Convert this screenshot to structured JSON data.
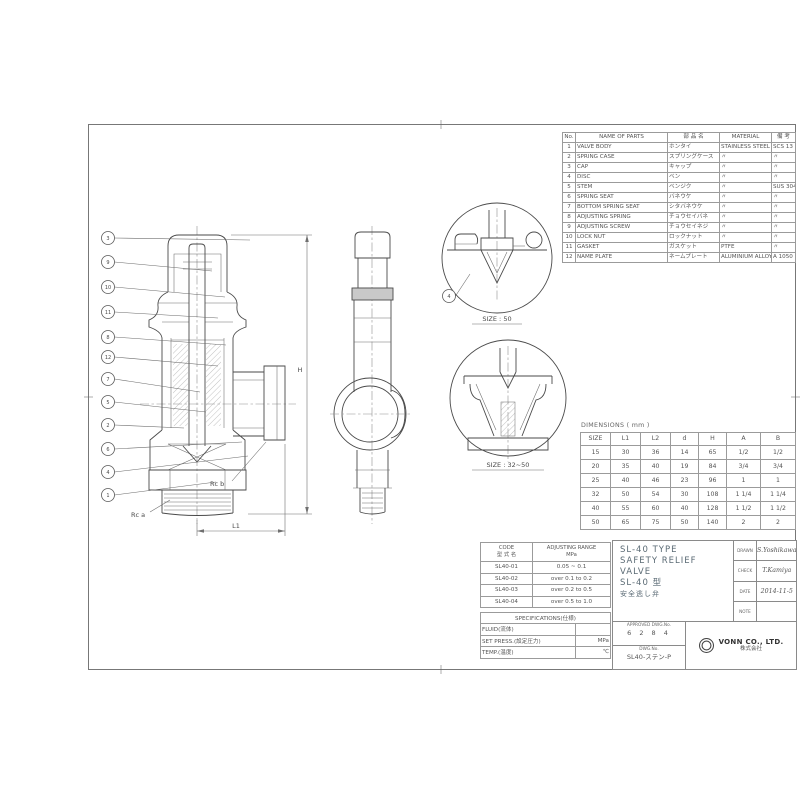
{
  "sheet": {
    "views": {
      "balloons": [
        "3",
        "9",
        "10",
        "11",
        "8",
        "12",
        "7",
        "5",
        "2",
        "6",
        "4",
        "1"
      ],
      "detail_balloon": "4",
      "label_rc_a": "Rc a",
      "label_rc_b": "Rc b",
      "dim_h": "H",
      "dim_l1": "L1",
      "detail1_caption": "SIZE : 50",
      "detail2_caption": "SIZE : 32~50"
    },
    "parts_table": {
      "headers": [
        "No.",
        "NAME OF PARTS",
        "部 品 名",
        "MATERIAL",
        "備 考"
      ],
      "rows": [
        [
          "1",
          "VALVE BODY",
          "ホンタイ",
          "STAINLESS STEEL",
          "SCS 13"
        ],
        [
          "2",
          "SPRING CASE",
          "スプリングケース",
          "〃",
          "〃"
        ],
        [
          "3",
          "CAP",
          "キャップ",
          "〃",
          "〃"
        ],
        [
          "4",
          "DISC",
          "ベン",
          "〃",
          "〃"
        ],
        [
          "5",
          "STEM",
          "ベンジク",
          "〃",
          "SUS 304"
        ],
        [
          "6",
          "SPRING SEAT",
          "バネウケ",
          "〃",
          "〃"
        ],
        [
          "7",
          "BOTTOM SPRING SEAT",
          "シタバネウケ",
          "〃",
          "〃"
        ],
        [
          "8",
          "ADJUSTING SPRING",
          "チョウセイバネ",
          "〃",
          "〃"
        ],
        [
          "9",
          "ADJUSTING SCREW",
          "チョウセイネジ",
          "〃",
          "〃"
        ],
        [
          "10",
          "LOCK NUT",
          "ロックナット",
          "〃",
          "〃"
        ],
        [
          "11",
          "GASKET",
          "ガスケット",
          "PTFE",
          "〃"
        ],
        [
          "12",
          "NAME PLATE",
          "ネームプレート",
          "ALUMINIUM ALLOY",
          "A 1050 P"
        ]
      ]
    },
    "dimensions_table": {
      "title": "DIMENSIONS ( mm )",
      "headers": [
        "SIZE",
        "L1",
        "L2",
        "d",
        "H",
        "A",
        "B"
      ],
      "rows": [
        [
          "15",
          "30",
          "36",
          "14",
          "65",
          "1/2",
          "1/2"
        ],
        [
          "20",
          "35",
          "40",
          "19",
          "84",
          "3/4",
          "3/4"
        ],
        [
          "25",
          "40",
          "46",
          "23",
          "96",
          "1",
          "1"
        ],
        [
          "32",
          "50",
          "54",
          "30",
          "108",
          "1 1/4",
          "1 1/4"
        ],
        [
          "40",
          "55",
          "60",
          "40",
          "128",
          "1 1/2",
          "1 1/2"
        ],
        [
          "50",
          "65",
          "75",
          "50",
          "140",
          "2",
          "2"
        ]
      ]
    },
    "code_table": {
      "header_code_en": "CODE",
      "header_code_jp": "型 式 名",
      "header_range_en": "ADJUSTING RANGE",
      "header_range_unit": "MPa",
      "rows": [
        [
          "SL40-01",
          "0.05 ~ 0.1"
        ],
        [
          "SL40-02",
          "over 0.1  to 0.2"
        ],
        [
          "SL40-03",
          "over 0.2  to 0.5"
        ],
        [
          "SL40-04",
          "over 0.5  to 1.0"
        ]
      ]
    },
    "spec_table": {
      "title": "SPECIFICATIONS(仕様)",
      "rows": [
        [
          "FLUID(流体)",
          ""
        ],
        [
          "SET PRESS.(設定圧力)",
          "MPa"
        ],
        [
          "TEMP.(温度)",
          "℃"
        ]
      ]
    },
    "title_block": {
      "title_lines": [
        "SL-40  TYPE",
        "SAFETY  RELIEF",
        "VALVE",
        "SL-40  型",
        "安全逃し弁"
      ],
      "sign_rows": [
        {
          "label": "DRAWN",
          "value": "S.Yoshikawa"
        },
        {
          "label": "CHECK",
          "value": "T.Kamiya"
        },
        {
          "label": "DATE",
          "value": "2014-11-5"
        },
        {
          "label": "NOTE",
          "value": ""
        }
      ],
      "approved_label": "APPROVED DWG.No.",
      "approved_value": "6 2 8 4",
      "dwg_label": "DWG.No.",
      "dwg_value": "SL40-ステン-P",
      "company_en": "VONN CO., LTD.",
      "company_jp": "株式会社"
    }
  }
}
